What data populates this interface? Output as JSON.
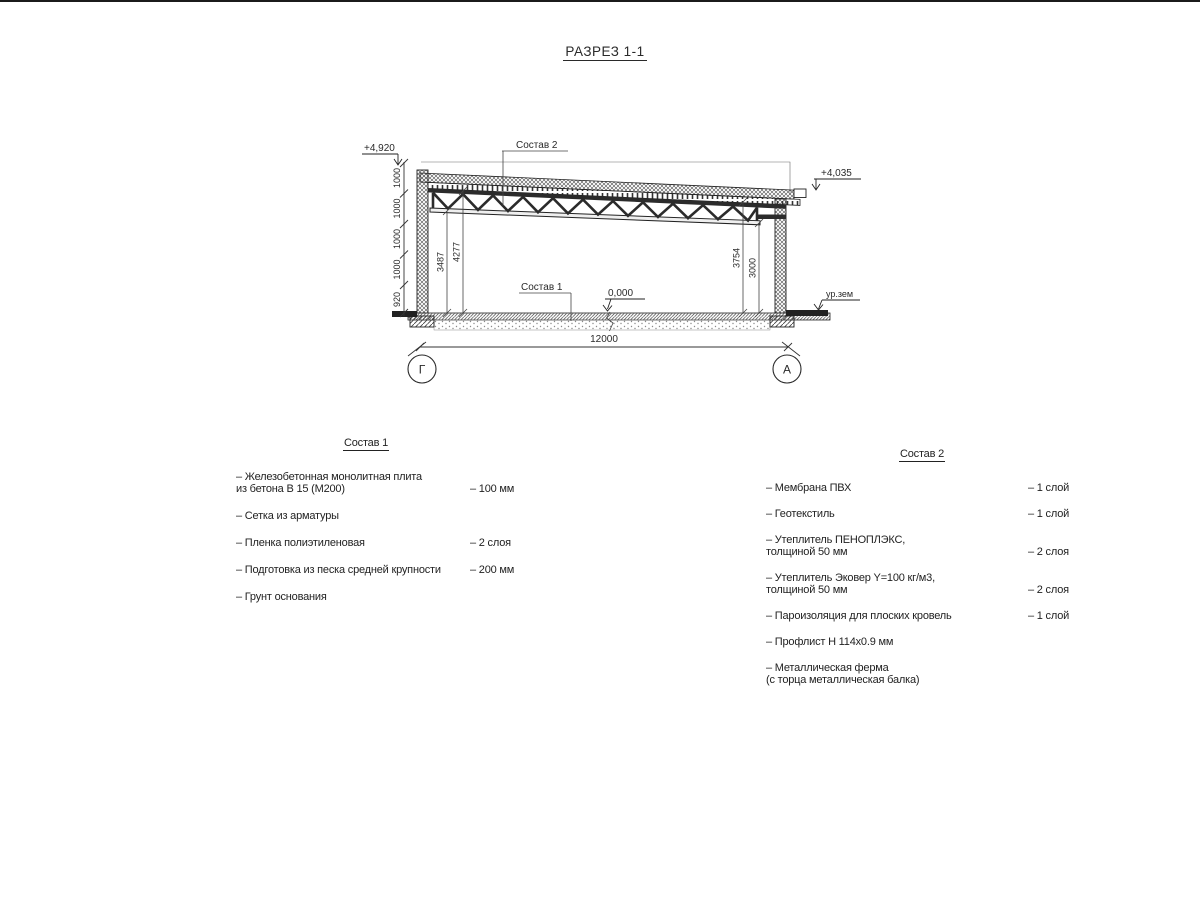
{
  "title": "РАЗРЕЗ 1-1",
  "section": {
    "elevations": {
      "parapet": "+4,920",
      "roof_edge": "+4,035",
      "floor": "0,000",
      "ground": "ур.зем"
    },
    "callouts": {
      "roof_composition": "Состав 2",
      "floor_composition": "Состав 1"
    },
    "dimensions": {
      "span": "12000",
      "left_chain": [
        "1000",
        "1000",
        "1000",
        "1000",
        "920"
      ],
      "interior_left": [
        "3487",
        "4277"
      ],
      "interior_right": [
        "3754",
        "3000"
      ]
    },
    "axes": {
      "left": "Г",
      "right": "А"
    }
  },
  "sostav1": {
    "header": "Состав 1",
    "items": [
      {
        "line1": "– Железобетонная  монолитная плита",
        "line2": "из бетона В 15 (М200)",
        "value": "– 100 мм"
      },
      {
        "line1": "– Сетка из арматуры",
        "line2": "",
        "value": ""
      },
      {
        "line1": "– Пленка полиэтиленовая",
        "line2": "",
        "value": "– 2 слоя"
      },
      {
        "line1": "– Подготовка из песка средней крупности",
        "line2": "",
        "value": "– 200 мм"
      },
      {
        "line1": "– Грунт основания",
        "line2": "",
        "value": ""
      }
    ]
  },
  "sostav2": {
    "header": "Состав 2",
    "items": [
      {
        "line1": "– Мембрана ПВХ",
        "line2": "",
        "value": "– 1 слой"
      },
      {
        "line1": "– Геотекстиль",
        "line2": "",
        "value": "– 1 слой"
      },
      {
        "line1": "– Утеплитель ПЕНОПЛЭКС,",
        "line2": "толщиной 50 мм",
        "value": "– 2 слоя"
      },
      {
        "line1": "– Утеплитель Эковер Y=100 кг/м3,",
        "line2": "толщиной 50 мм",
        "value": "– 2 слоя"
      },
      {
        "line1": "– Пароизоляция для плоских кровель",
        "line2": "",
        "value": "– 1 слой"
      },
      {
        "line1": "– Профлист Н 114х0.9 мм",
        "line2": "",
        "value": ""
      },
      {
        "line1": "– Металлическая ферма",
        "line2": "(с торца металлическая балка)",
        "value": ""
      }
    ]
  }
}
